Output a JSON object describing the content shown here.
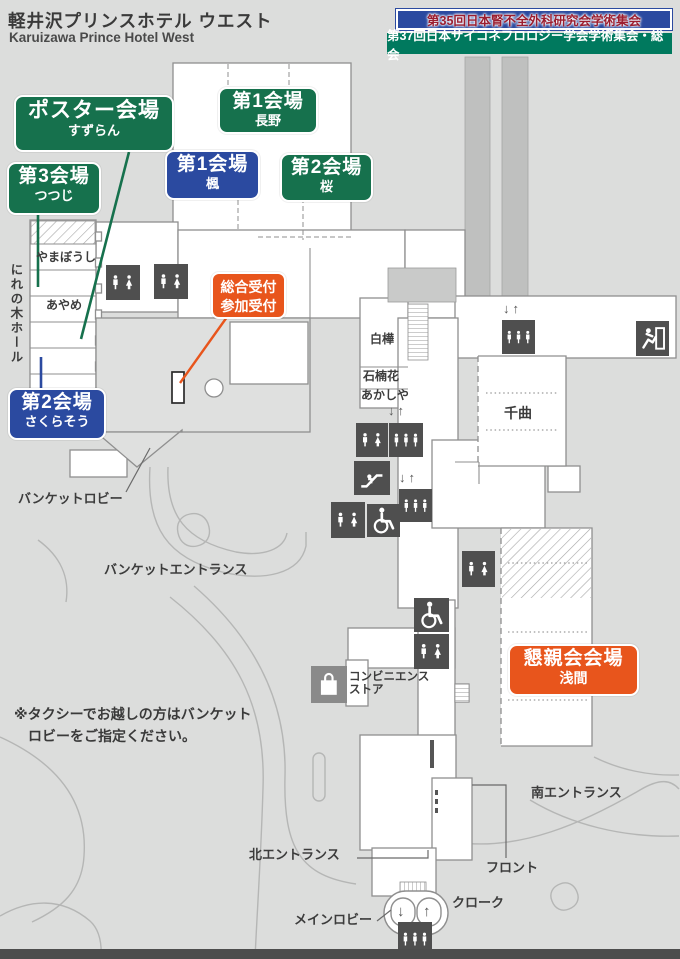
{
  "header": {
    "title": "軽井沢プリンスホテル ウエスト",
    "subtitle": "Karuizawa Prince Hotel West",
    "banner1": {
      "text": "第35回日本腎不全外科研究会学術集会",
      "bg": "#2b4aa0",
      "text_color": "#9b1e30"
    },
    "banner2": {
      "text": "第37回日本サイコネフロロジー学会学術集会・総会",
      "bg": "#00795e",
      "text_color": "#ffffff"
    }
  },
  "venues": {
    "poster": {
      "label": "ポスター会場",
      "sub": "すずらん",
      "color": "#16714d"
    },
    "hall1_nagano": {
      "label": "第1会場",
      "sub": "長野",
      "color": "#16714d"
    },
    "hall1_kaede": {
      "label": "第1会場",
      "sub": "楓",
      "color": "#2b4aa0"
    },
    "hall2_sakura": {
      "label": "第2会場",
      "sub": "桜",
      "color": "#16714d"
    },
    "hall3_tsutsuji": {
      "label": "第3会場",
      "sub": "つつじ",
      "color": "#16714d"
    },
    "hall2_sakurasou": {
      "label": "第2会場",
      "sub": "さくらそう",
      "color": "#2b4aa0"
    },
    "reception": {
      "line1": "総合受付",
      "line2": "参加受付",
      "color": "#e8551c"
    },
    "party": {
      "label": "懇親会会場",
      "sub": "浅間",
      "color": "#e8551c"
    }
  },
  "rooms": {
    "nirenoki": "にれの木ホール",
    "yamaboushi": "やまぼうし",
    "ayame": "あやめ",
    "shirakaba": "白樺",
    "shakunage": "石楠花",
    "akashiya": "あかしや",
    "chikuma": "千曲"
  },
  "places": {
    "banquet_lobby": "バンケットロビー",
    "banquet_entrance": "バンケットエントランス",
    "convenience1": "コンビニエンス",
    "convenience2": "ストア",
    "south_entrance": "南エントランス",
    "north_entrance": "北エントランス",
    "front": "フロント",
    "main_lobby": "メインロビー",
    "cloak": "クローク"
  },
  "note": {
    "line1": "※タクシーでお越しの方はバンケット",
    "line2": "ロビーをご指定ください。"
  },
  "glyphs": {
    "down_up": "↓↑",
    "down": "↓",
    "up": "↑"
  },
  "icons": {
    "restroom": "restroom-icon",
    "elevator": "elevator-icon",
    "escalator": "escalator-icon",
    "wheelchair": "wheelchair-icon",
    "exit": "emergency-exit-icon",
    "store": "shopping-bag-icon"
  },
  "colors": {
    "green": "#16714d",
    "blue": "#2b4aa0",
    "orange": "#e8551c",
    "icon_bg": "#4f4f4f",
    "store_bg": "#8a8a8a",
    "wall": "#8f8f8f",
    "road": "#b5b6b5",
    "footer_bar": "#4d4d4d"
  }
}
